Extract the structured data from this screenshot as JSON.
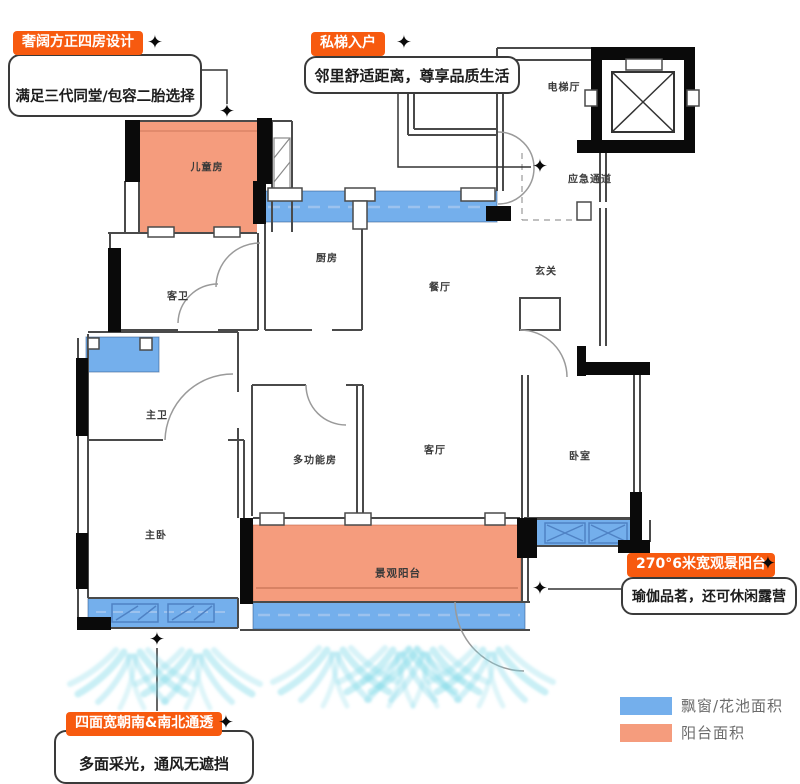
{
  "callouts": {
    "four_rooms": {
      "badge": "奢阔方正四房设计",
      "text": "满足三代同堂/包容二胎选择"
    },
    "private_lift": {
      "badge": "私梯入户",
      "text": "邻里舒适距离，尊享品质生活"
    },
    "view_balcony": {
      "badge": "270°6米宽观景阳台",
      "text": "瑜伽品茗，还可休闲露营"
    },
    "south_facing": {
      "badge": "四面宽朝南&南北通透",
      "text": "多面采光，通风无遮挡"
    }
  },
  "rooms": {
    "children_room": "儿童房",
    "kitchen": "厨房",
    "dining_room": "餐厅",
    "elevator_hall": "电梯厅",
    "emergency_passage": "应急通道",
    "entryway": "玄关",
    "guest_bathroom": "客卫",
    "master_bathroom": "主卫",
    "multifunction_room": "多功能房",
    "living_room": "客厅",
    "bedroom": "卧室",
    "master_bedroom": "主卧",
    "view_balcony": "景观阳台"
  },
  "legend": {
    "items": [
      {
        "label": "飘窗/花池面积",
        "color": "#74afec"
      },
      {
        "label": "阳台面积",
        "color": "#f59c7d"
      }
    ]
  },
  "icons": {
    "diamond_marker": "✦"
  },
  "colors": {
    "badge_orange": "#f75a0f",
    "balcony_fill": "#f59c7d",
    "window_fill": "#74afec",
    "airflow_cyan": "#7fd8e8",
    "wall_black": "#0a0a0a",
    "line_gray": "#4a4a4a"
  }
}
